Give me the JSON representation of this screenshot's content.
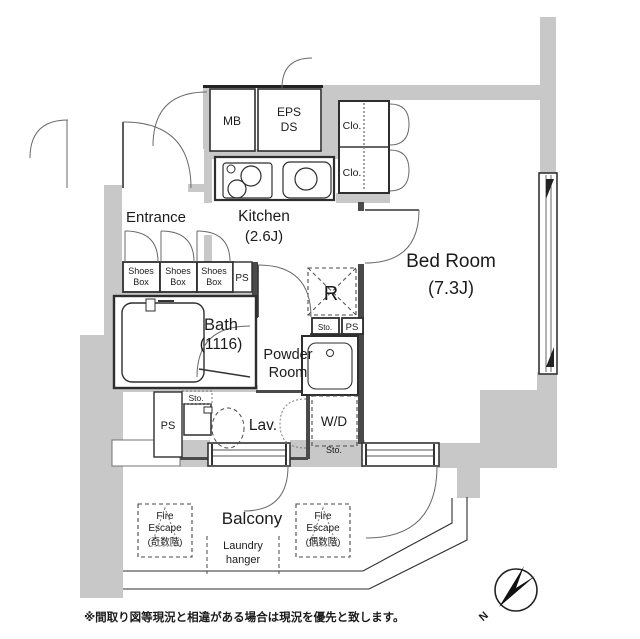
{
  "plan": {
    "colors": {
      "wall": "#c8c8c8",
      "line": "#2e2e2e"
    },
    "rooms": {
      "entrance": "Entrance",
      "kitchen": "Kitchen",
      "kitchen_size": "(2.6J)",
      "bedroom": "Bed Room",
      "bedroom_size": "(7.3J)",
      "bath": "Bath",
      "bath_size": "(1116)",
      "powder_line1": "Powder",
      "powder_line2": "Room",
      "lav": "Lav.",
      "balcony": "Balcony"
    },
    "labels": {
      "mb": "MB",
      "eps": "EPS",
      "ds": "DS",
      "clo": "Clo.",
      "shoes_line1": "Shoes",
      "shoes_line2": "Box",
      "ps": "PS",
      "refrigerator": "R",
      "sto": "Sto.",
      "wd": "W/D",
      "fire_line1": "Fire",
      "fire_line2": "Escape",
      "fire_left_line3": "(奇数階)",
      "fire_right_line3": "(偶数階)",
      "laundry_line1": "Laundry",
      "laundry_line2": "hanger",
      "compass_north": "N"
    },
    "note": "※間取り図等現況と相違がある場合は現況を優先と致します。"
  }
}
